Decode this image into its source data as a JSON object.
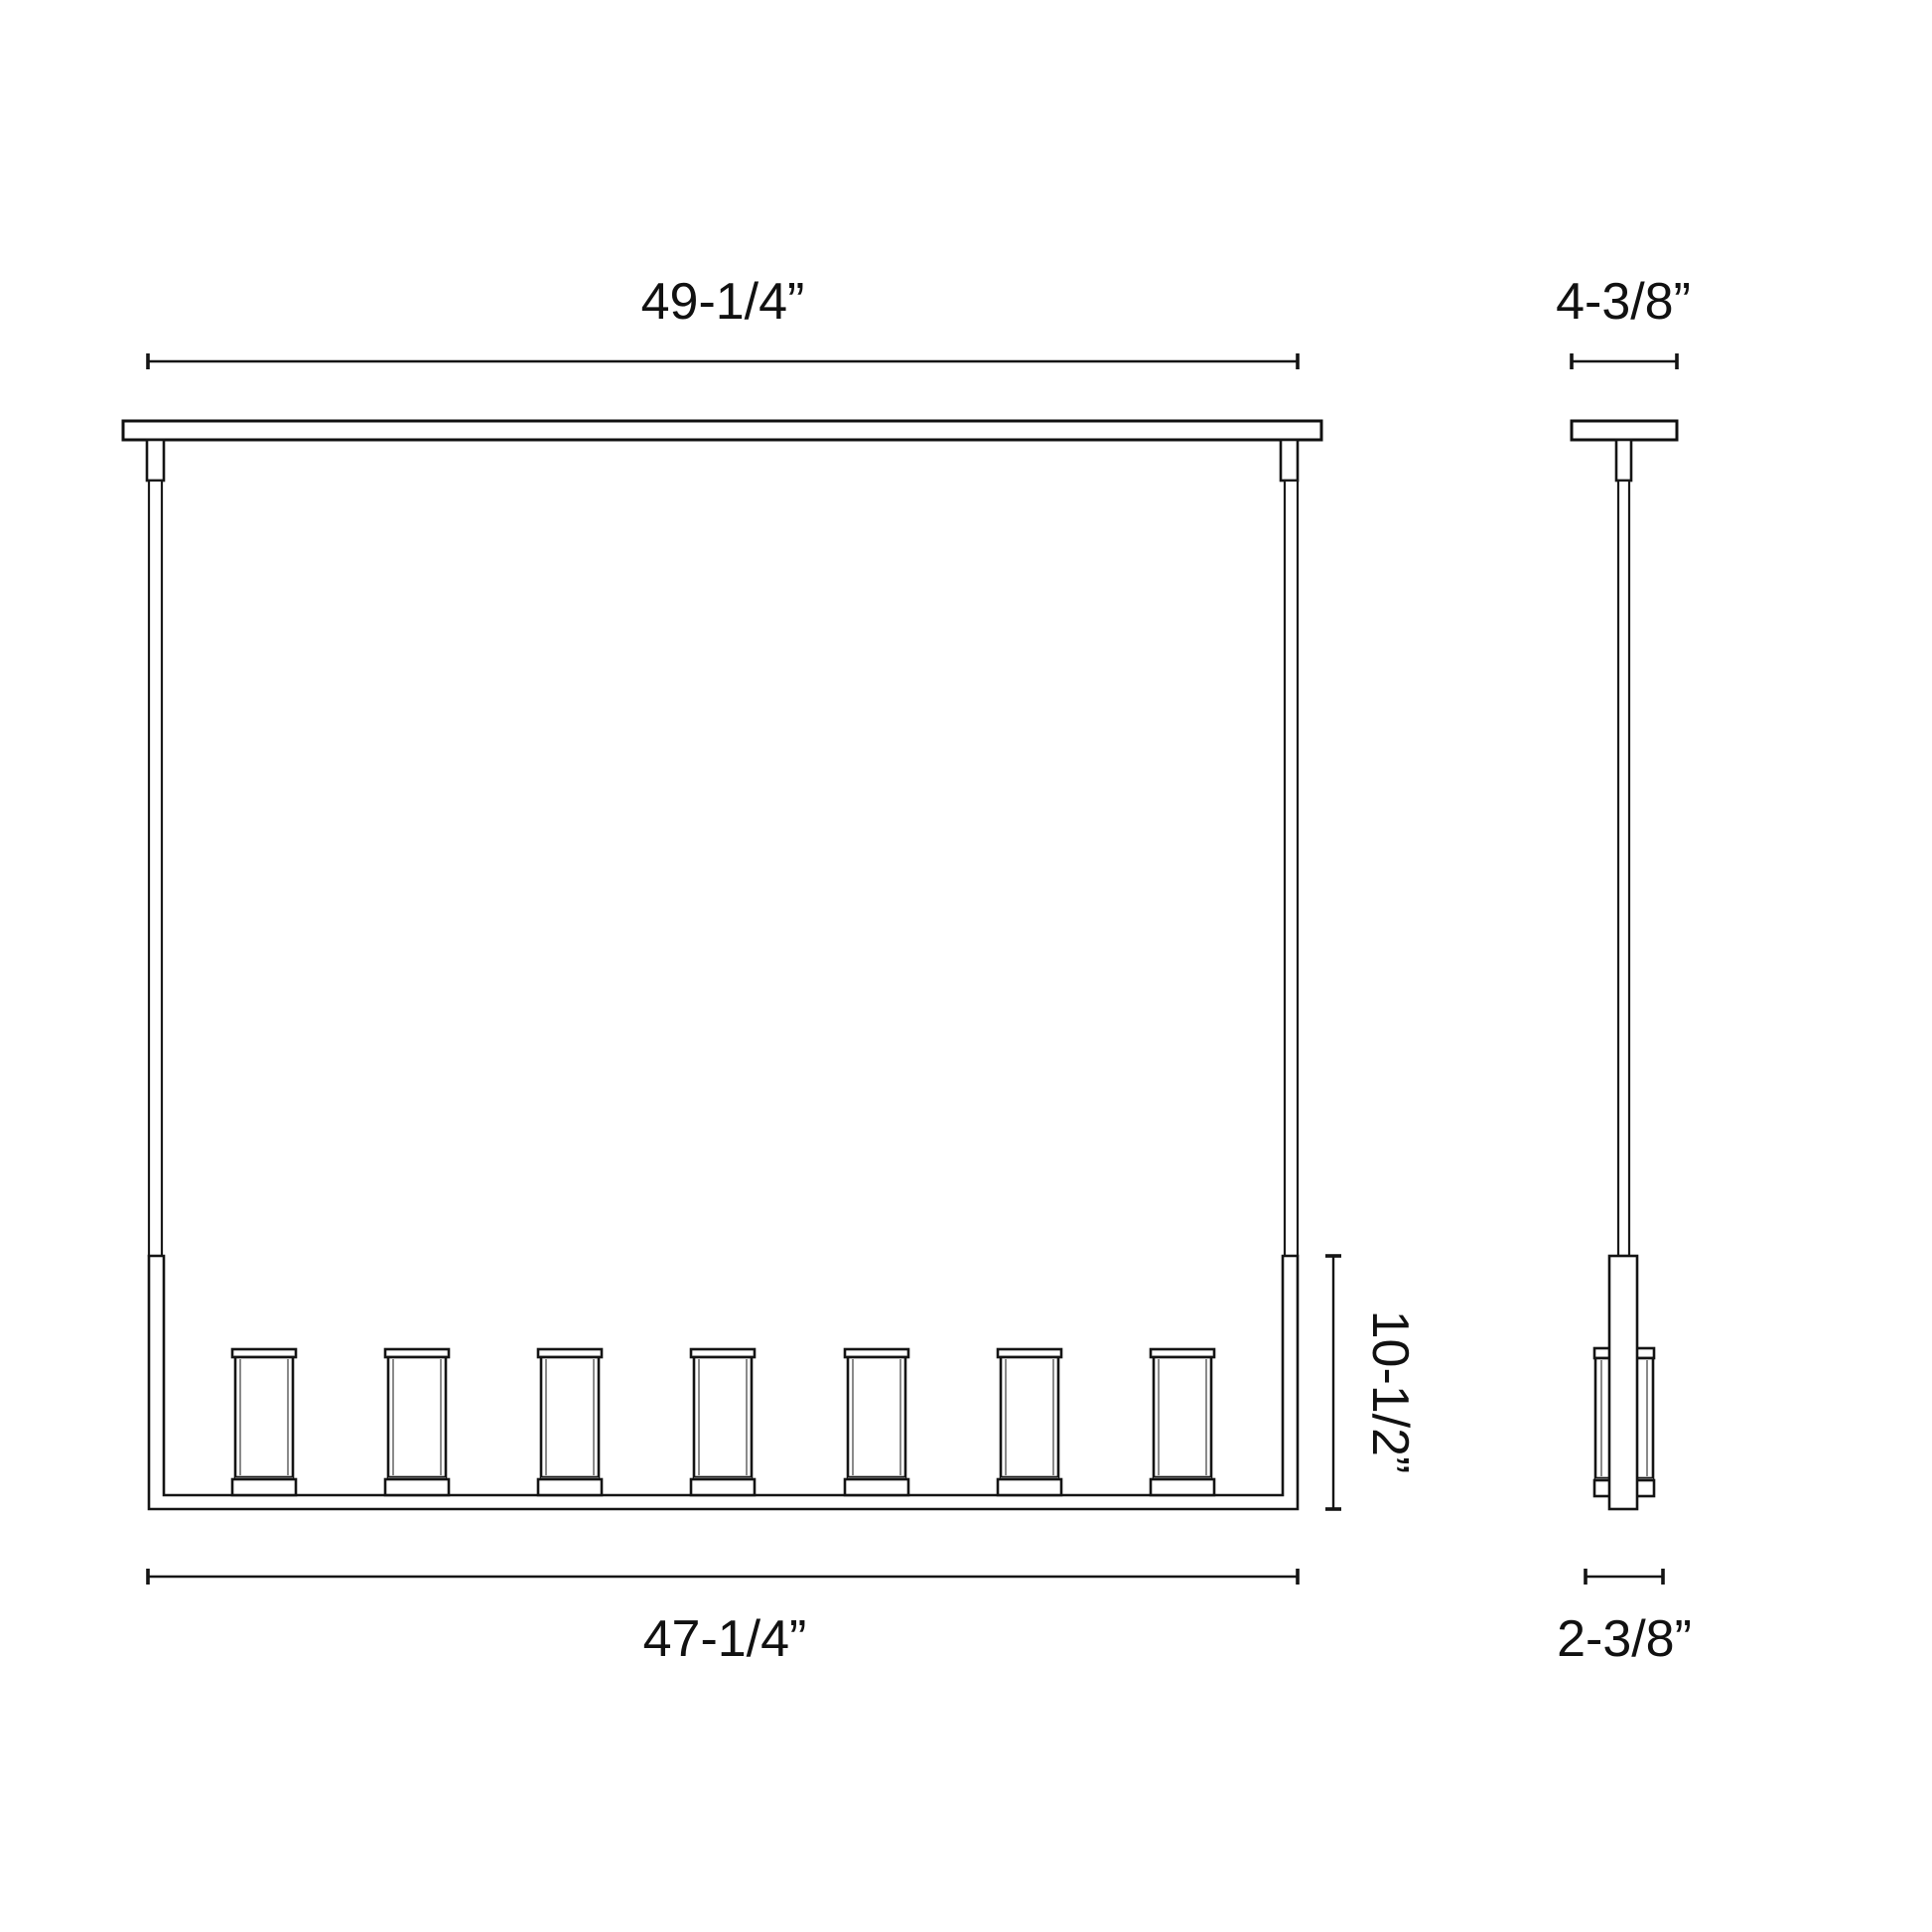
{
  "document": {
    "type": "technical-dimension-drawing",
    "subject": "linear-pendant-chandelier",
    "background_color": "#ffffff",
    "line_color": "#141414",
    "detail_line_color": "#8a8a8a"
  },
  "front_view": {
    "name": "front elevation",
    "candle_count": 7,
    "dimensions": {
      "overall_width": "49-1/4”",
      "frame_width": "47-1/4”",
      "frame_height": "10-1/2”"
    }
  },
  "side_view": {
    "name": "side elevation",
    "candle_count": 1,
    "dimensions": {
      "canopy_width": "4-3/8”",
      "frame_depth": "2-3/8”"
    }
  }
}
